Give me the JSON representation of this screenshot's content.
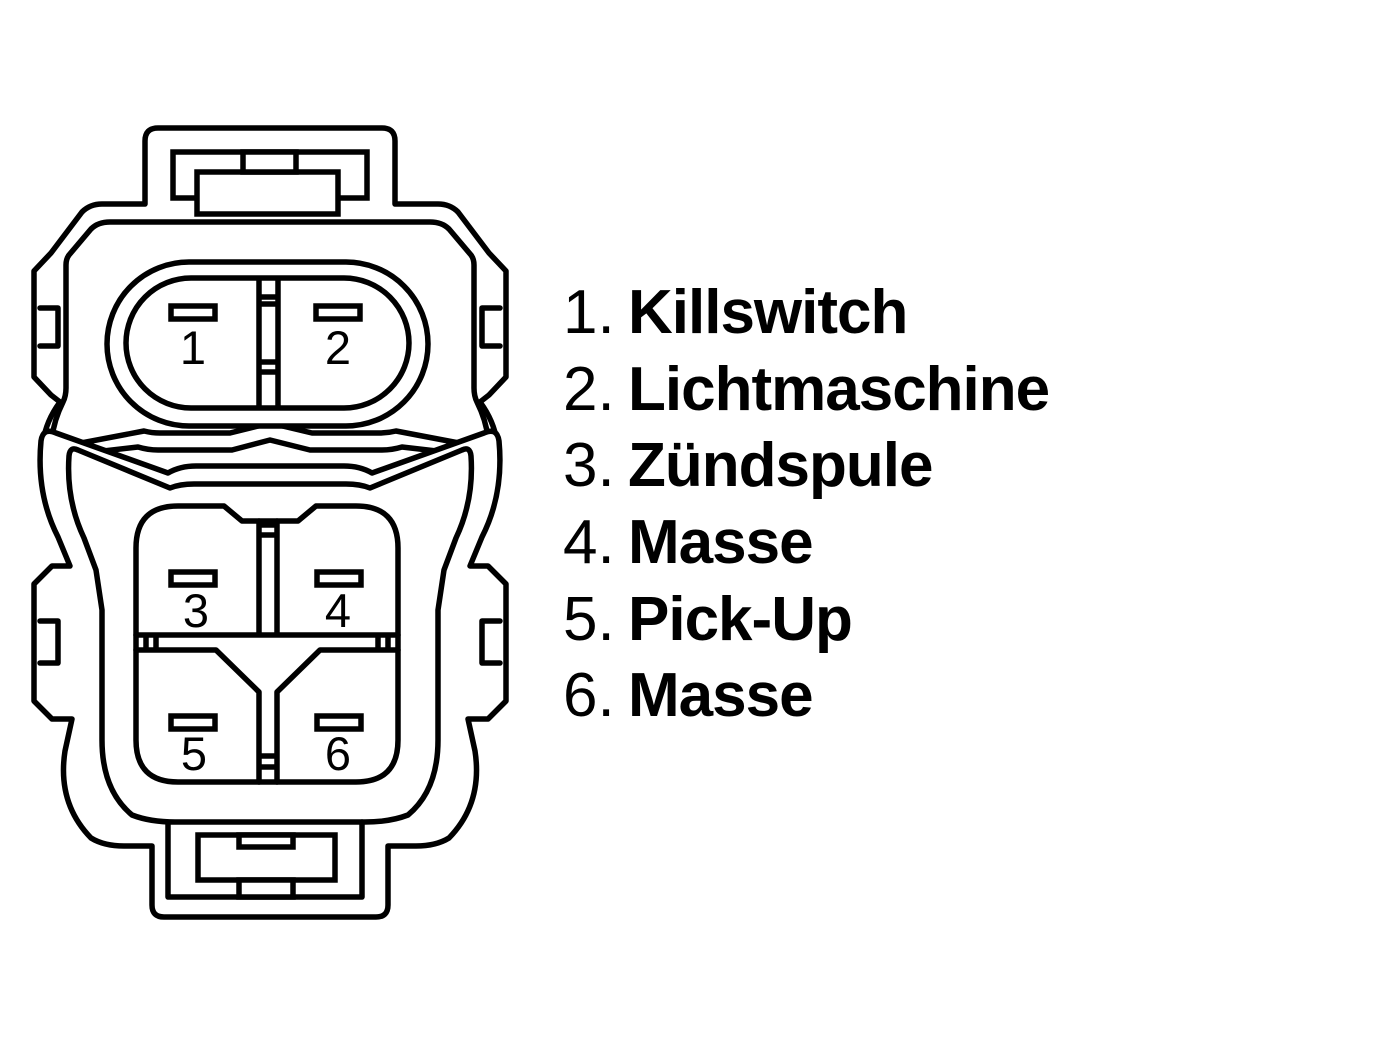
{
  "diagram": {
    "title": "connector-pinout-diagram",
    "colors": {
      "line": "#000000",
      "background": "#ffffff"
    },
    "top_connector": {
      "name": "2-pin-connector-face",
      "pins": [
        {
          "number": "1"
        },
        {
          "number": "2"
        }
      ]
    },
    "bottom_connector": {
      "name": "4-pin-connector-face",
      "pins": [
        {
          "number": "3"
        },
        {
          "number": "4"
        },
        {
          "number": "5"
        },
        {
          "number": "6"
        }
      ]
    }
  },
  "legend": {
    "items": [
      {
        "num": "1.",
        "label": "Killswitch"
      },
      {
        "num": "2.",
        "label": "Lichtmaschine"
      },
      {
        "num": "3.",
        "label": "Zündspule"
      },
      {
        "num": "4.",
        "label": "Masse"
      },
      {
        "num": "5.",
        "label": "Pick-Up"
      },
      {
        "num": "6.",
        "label": "Masse"
      }
    ]
  }
}
